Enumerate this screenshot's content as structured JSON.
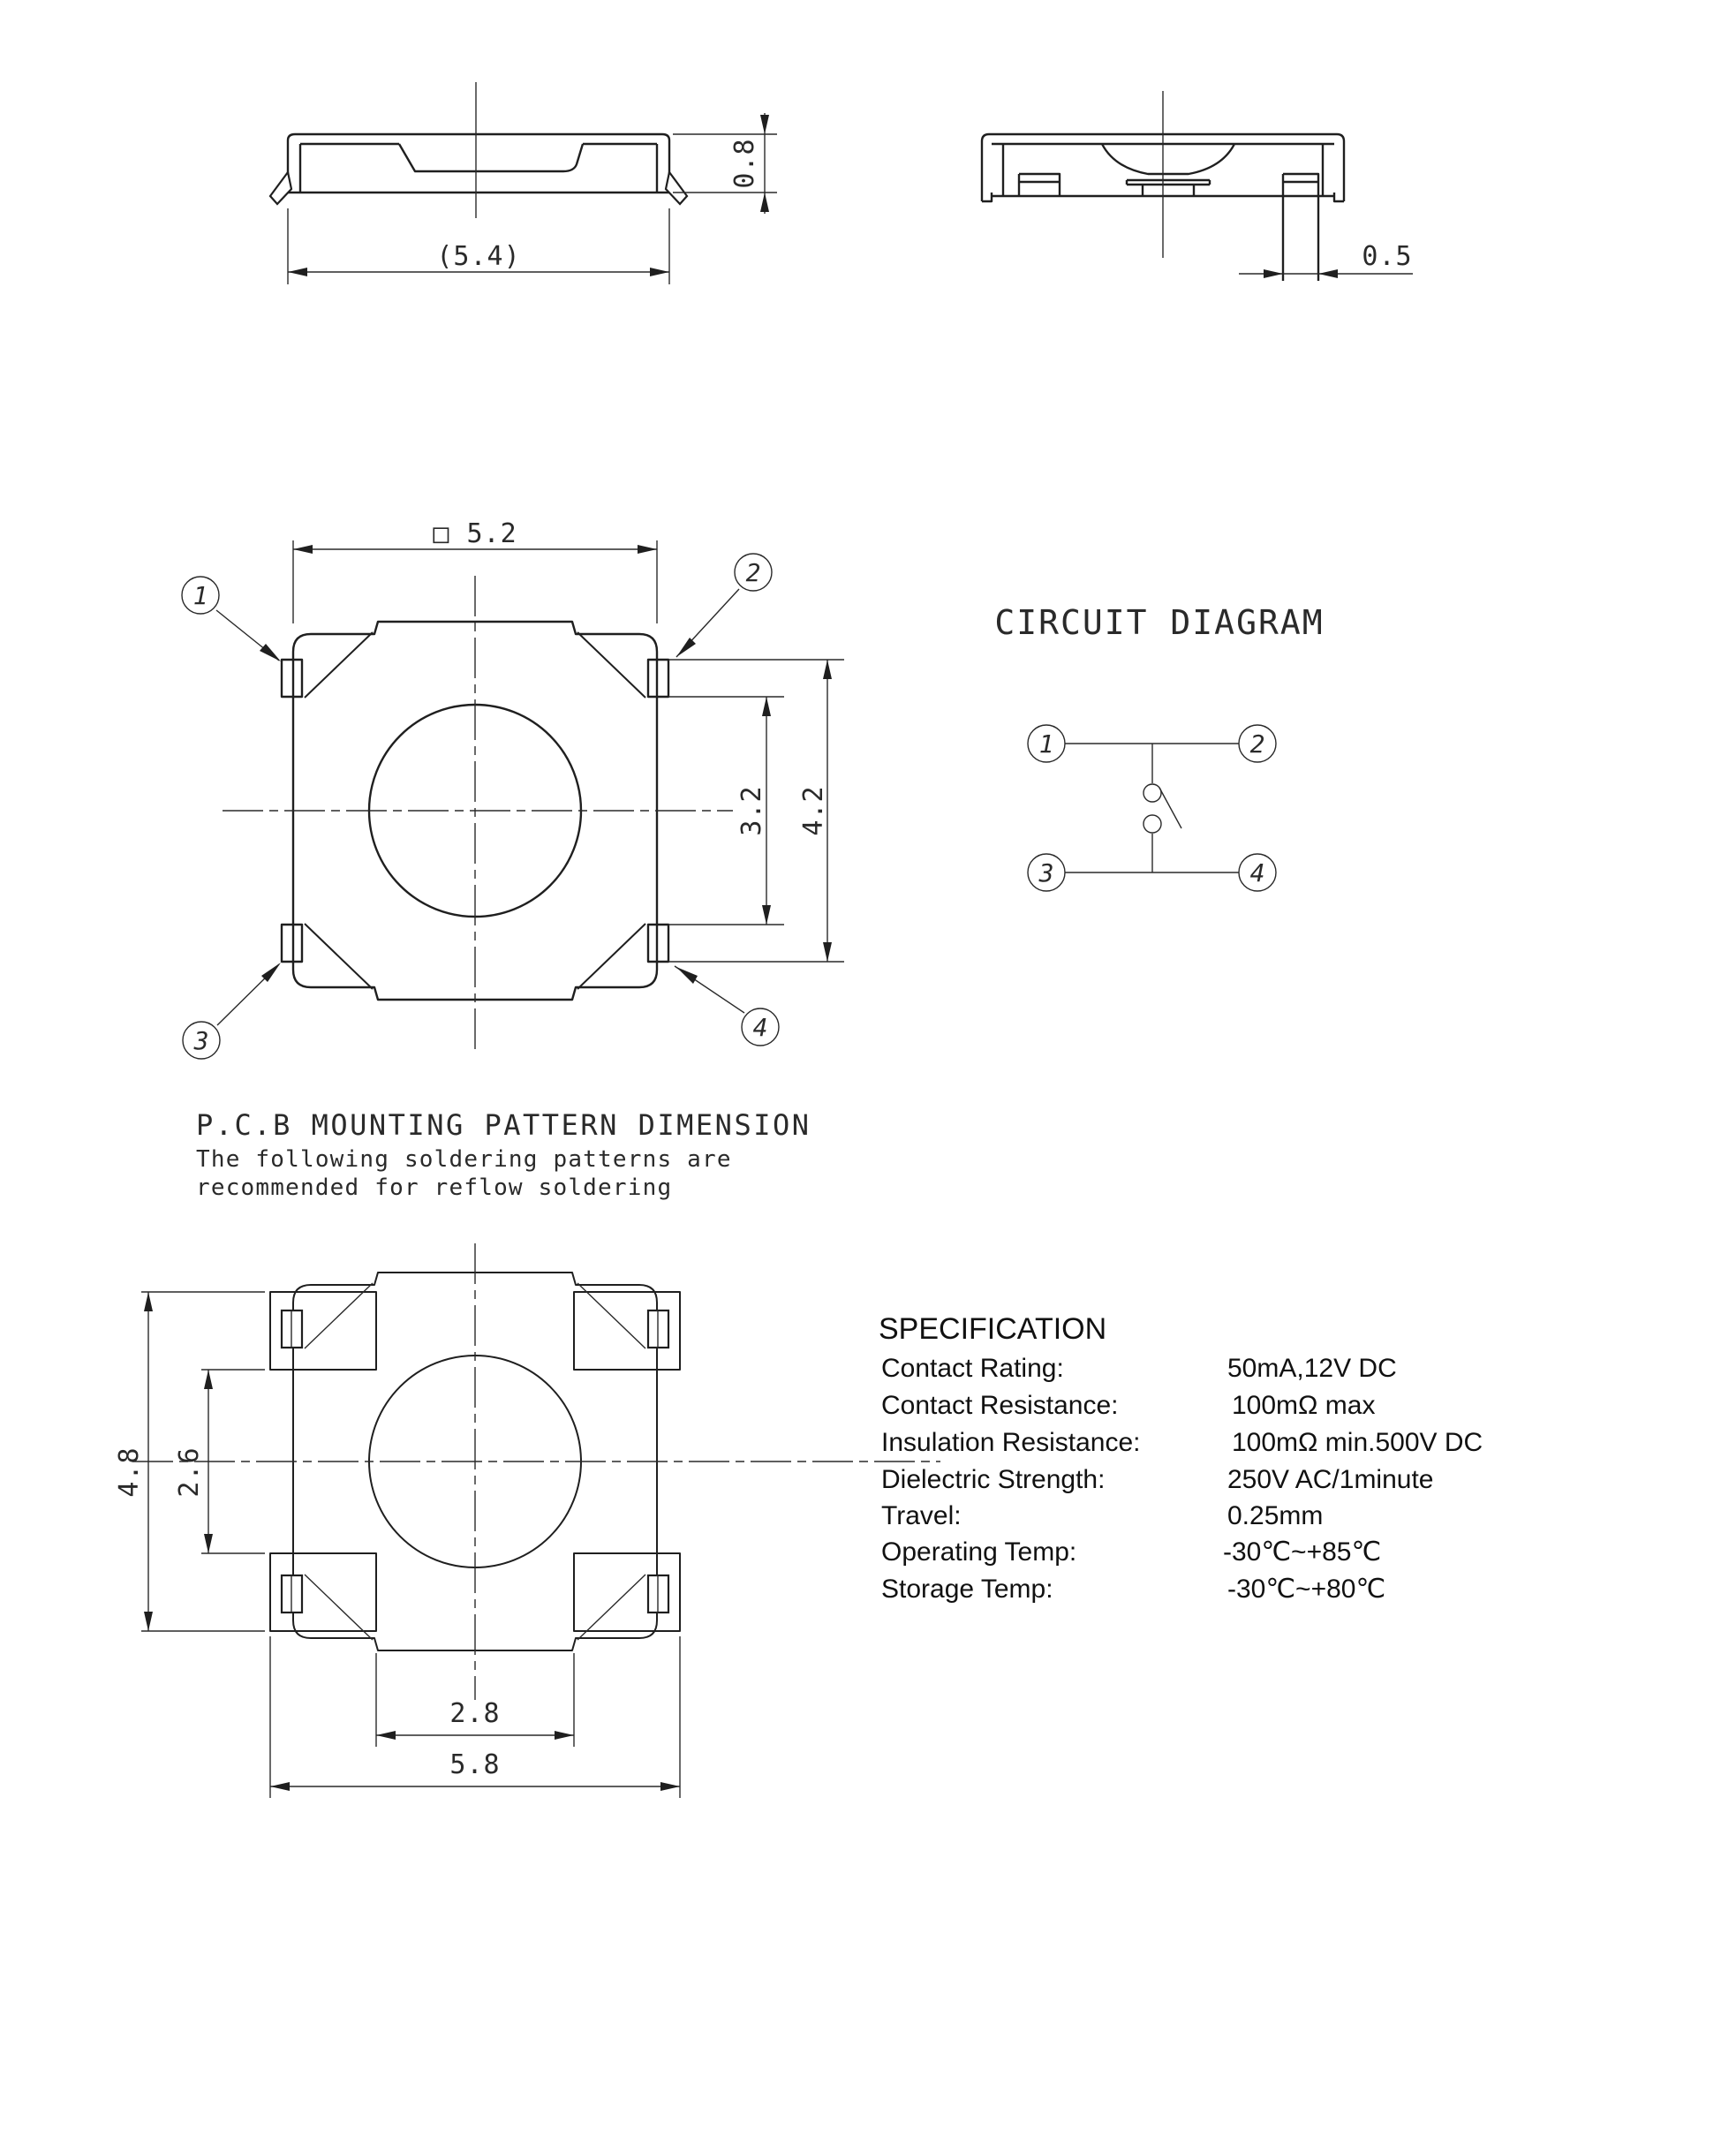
{
  "drawing": {
    "side_front": {
      "dim_width": "(5.4)",
      "dim_height": "0.8"
    },
    "side_section": {
      "dim_pin_width": "0.5"
    },
    "top_view": {
      "dim_width": "□ 5.2",
      "dim_pin_inner": "3.2",
      "dim_pin_outer": "4.2",
      "pin_labels": [
        "1",
        "2",
        "3",
        "4"
      ]
    },
    "circuit": {
      "title": "CIRCUIT DIAGRAM",
      "terminals": [
        "1",
        "2",
        "3",
        "4"
      ]
    },
    "pcb_pattern": {
      "title": "P.C.B MOUNTING PATTERN DIMENSION",
      "subtitle_line1": "The following soldering patterns are",
      "subtitle_line2": "recommended for reflow soldering",
      "dim_outer_height": "4.8",
      "dim_inner_height": "2.6",
      "dim_inner_width": "2.8",
      "dim_outer_width": "5.8"
    },
    "specification": {
      "title": "SPECIFICATION",
      "rows": [
        {
          "label": "Contact Rating:",
          "value": "50mA,12V DC"
        },
        {
          "label": "Contact Resistance:",
          "value": "100mΩ max"
        },
        {
          "label": "Insulation Resistance:",
          "value": "100mΩ min.500V DC"
        },
        {
          "label": "Dielectric Strength:",
          "value": "250V AC/1minute"
        },
        {
          "label": "Travel:",
          "value": "0.25mm"
        },
        {
          "label": "Operating Temp:",
          "value": "-30℃~+85℃"
        },
        {
          "label": "Storage Temp:",
          "value": "-30℃~+80℃"
        }
      ]
    }
  }
}
